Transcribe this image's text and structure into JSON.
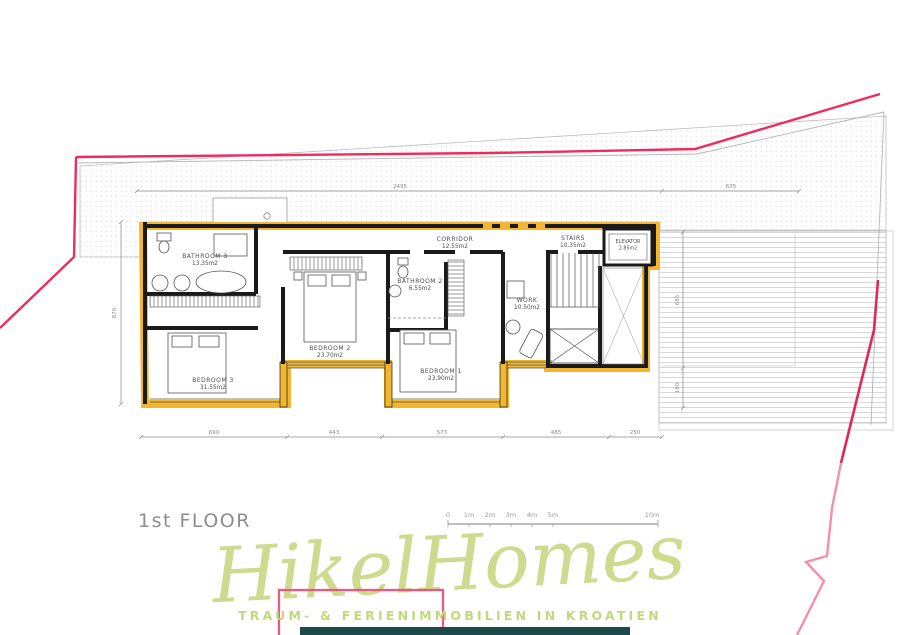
{
  "title": "1st FLOOR",
  "rooms": [
    {
      "name": "BATHROOM 3",
      "area": "13.35m2"
    },
    {
      "name": "BEDROOM 3",
      "area": "31.55m2"
    },
    {
      "name": "BEDROOM 2",
      "area": "23.70m2"
    },
    {
      "name": "BATHROOM 2",
      "area": "6.55m2"
    },
    {
      "name": "BEDROOM 1",
      "area": "23.90m2"
    },
    {
      "name": "CORRIDOR",
      "area": "12.55m2"
    },
    {
      "name": "WORK",
      "area": "10.50m2"
    },
    {
      "name": "STAIRS",
      "area": "10.35m2"
    },
    {
      "name": "ELEVATOR",
      "area": "2.85m2"
    }
  ],
  "dimensions": {
    "top": [
      "2435",
      "635"
    ],
    "bottom": [
      "690",
      "443",
      "573",
      "485",
      "250"
    ],
    "left": "870",
    "right": [
      "685",
      "180"
    ]
  },
  "scale_bar": [
    "0",
    "1m",
    "2m",
    "3m",
    "4m",
    "5m",
    "10m"
  ],
  "logo": {
    "script": "HikelHomes",
    "tagline": "TRAUM- & FERIENIMMOBILIEN IN KROATIEN"
  },
  "colors": {
    "boundary_pink": "#ed2b5e",
    "boundary_pink_light": "#f48fab",
    "wall_black": "#1a1a1a",
    "window_yellow": "#f2b630",
    "logo_green": "#ccdb8d",
    "teal_bar": "#1d4a48"
  }
}
